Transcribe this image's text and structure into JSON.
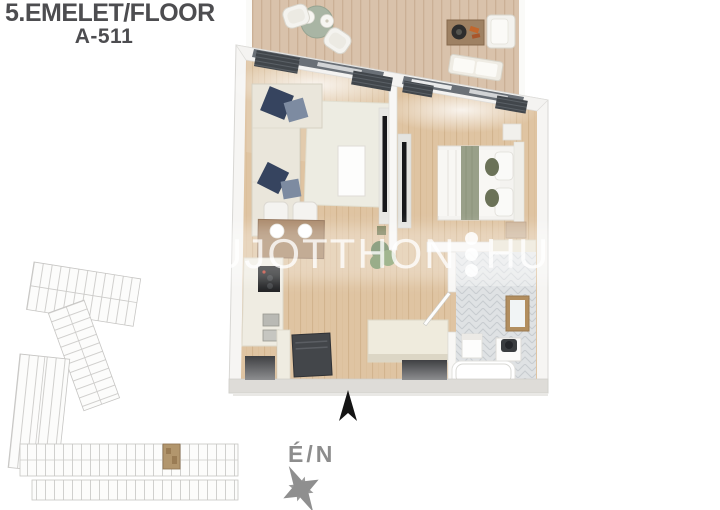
{
  "header": {
    "floor_label": "5.EMELET/FLOOR",
    "unit_label": "A-511"
  },
  "watermark": {
    "left": "UJOTTHON",
    "right": "HU",
    "separator": "three-vertical-dots"
  },
  "compass": {
    "label": "É/N",
    "north_arrow": "up"
  },
  "key_plan": {
    "highlighted_unit": "A-511",
    "highlight_color": "#b2966d"
  },
  "plan": {
    "view": "3d-top-down-apartment",
    "regions": [
      "balcony",
      "living-room",
      "bedroom",
      "kitchen-dining",
      "hallway",
      "entry",
      "bathroom"
    ]
  },
  "palette": {
    "background": "#ffffff",
    "title_text": "#4d4d50",
    "compass_text": "#8d8d8d",
    "deck_wood": "#d9c2ab",
    "floor_wood": "#dfc4a2",
    "walls": "#f6f5f3",
    "sofa_cream": "#eae6db",
    "pillow_navy": "#36445f",
    "pillow_slate": "#7d8ba1",
    "dining_table_wood": "#a98868",
    "bathroom_tile": "#dfe2e4",
    "window_glass": "#6a7077",
    "watermark_white": "rgba(255,255,255,0.78)"
  }
}
